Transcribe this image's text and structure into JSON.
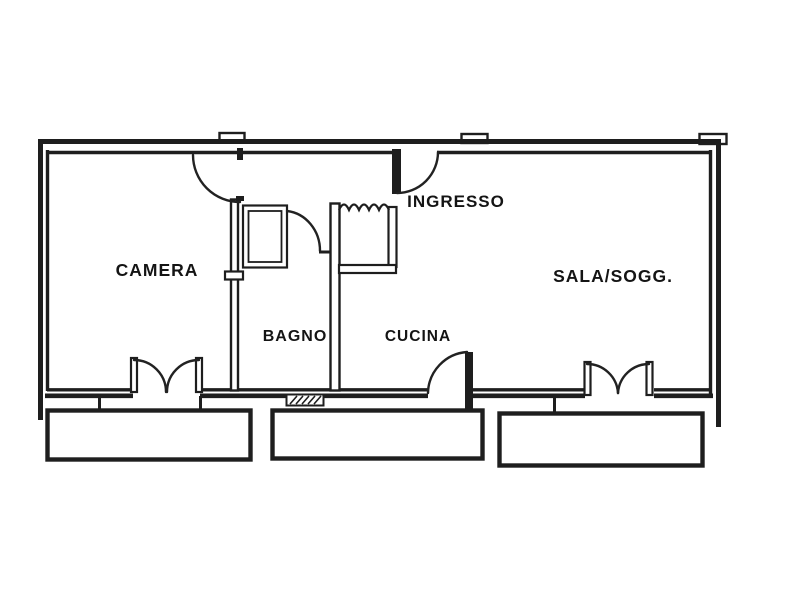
{
  "plan": {
    "kind": "apartment-floor-plan",
    "rooms": {
      "camera": "CAMERA",
      "bagno": "BAGNO",
      "cucina": "CUCINA",
      "ingresso": "INGRESSO",
      "sala_soggiorno": "SALA/SOGG."
    },
    "colors": {
      "line": "#1e1e1e",
      "background": "#ffffff"
    }
  }
}
